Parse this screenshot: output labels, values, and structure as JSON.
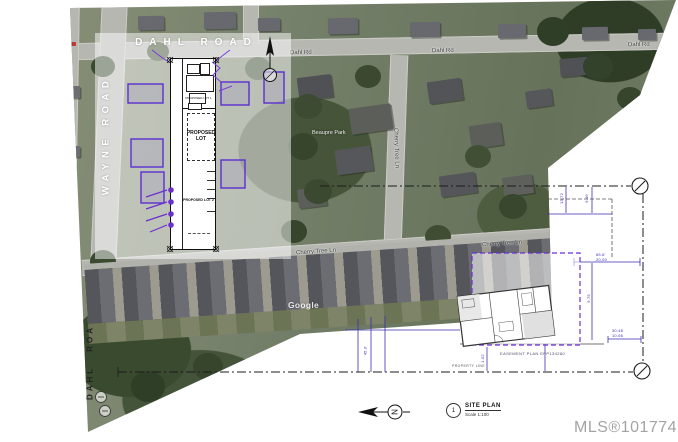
{
  "aerial": {
    "road_dahl": "Dahl Rd",
    "road_cherry": "Cherry Tree Ln",
    "place": "Beaupre Park",
    "credit": "Google"
  },
  "overlay": {
    "dahl_road": "DAHL ROAD",
    "wayne_road": "WAYNE ROAD",
    "dahl_road_partial": "DAHL ROA"
  },
  "site_plan": {
    "lot1": "PROPOSED LOT 1",
    "lot_main": "PROPOSED LOT",
    "lot2": "PROPOSED LOT 2"
  },
  "survey": {
    "easement": "EASEMENT PLAN EPP134280",
    "property_line": "PROPERTY LINE",
    "dims": {
      "a": "13.72",
      "b": "9.46",
      "c": "65.6'",
      "d": "20.00",
      "e": "30.48",
      "f": "10.06",
      "g": "9.75",
      "h": "1.52",
      "i": "45.0'"
    }
  },
  "titleblock": {
    "number": "1",
    "title": "SITE PLAN",
    "scale": "Scale 1:100",
    "north": "N"
  },
  "watermark": "MLS®1017746",
  "colors": {
    "outline_purple": "#5a2fd0",
    "dim_blue": "#3d2eb0",
    "linework": "#1c1c1c",
    "road_gray": "#b5b7b0",
    "mls_gray": "#a3a3a3"
  }
}
